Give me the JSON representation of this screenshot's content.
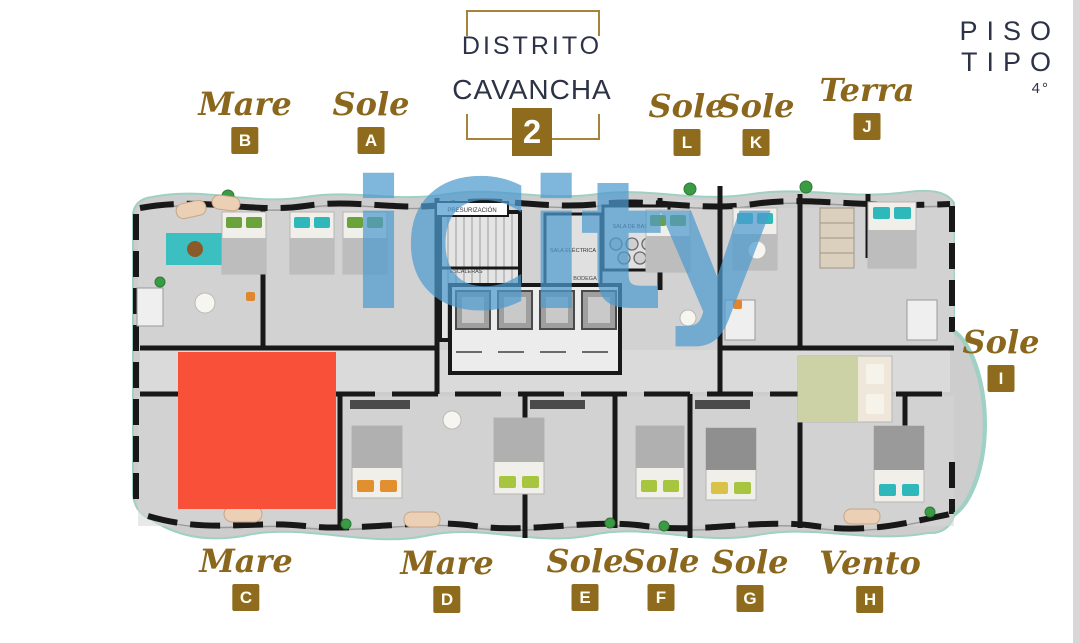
{
  "header": {
    "logo": {
      "line1": "DISTRITO",
      "line2": "CAVANCHA",
      "number": "2"
    },
    "floor_label": {
      "title": "PISO TIPO",
      "floor": "4°"
    }
  },
  "watermark": {
    "text": "iCity"
  },
  "units": {
    "top": [
      {
        "name": "Mare",
        "letter": "B"
      },
      {
        "name": "Sole",
        "letter": "A"
      },
      {
        "name": "Sole",
        "letter": "L"
      },
      {
        "name": "Sole",
        "letter": "K"
      },
      {
        "name": "Terra",
        "letter": "J"
      }
    ],
    "right": [
      {
        "name": "Sole",
        "letter": "I"
      }
    ],
    "bottom": [
      {
        "name": "Mare",
        "letter": "C"
      },
      {
        "name": "Mare",
        "letter": "D"
      },
      {
        "name": "Sole",
        "letter": "E"
      },
      {
        "name": "Sole",
        "letter": "F"
      },
      {
        "name": "Sole",
        "letter": "G"
      },
      {
        "name": "Vento",
        "letter": "H"
      }
    ]
  },
  "plan": {
    "rooms": {
      "presurizacion": "PRESURIZACIÓN",
      "escaleras": "ESCALERAS",
      "sala_electrica": "SALA ELÉCTRICA",
      "sala_basura": "SALA DE BASURA",
      "bodega": "BODEGA"
    },
    "highlight_color": "#f9503a"
  },
  "colors": {
    "gold": "#8e6b1d",
    "navy": "#2d3347",
    "watermark_blue": "#4e9bd0",
    "highlight_red": "#f9503a",
    "balcony_teal": "#9fd0c4"
  }
}
